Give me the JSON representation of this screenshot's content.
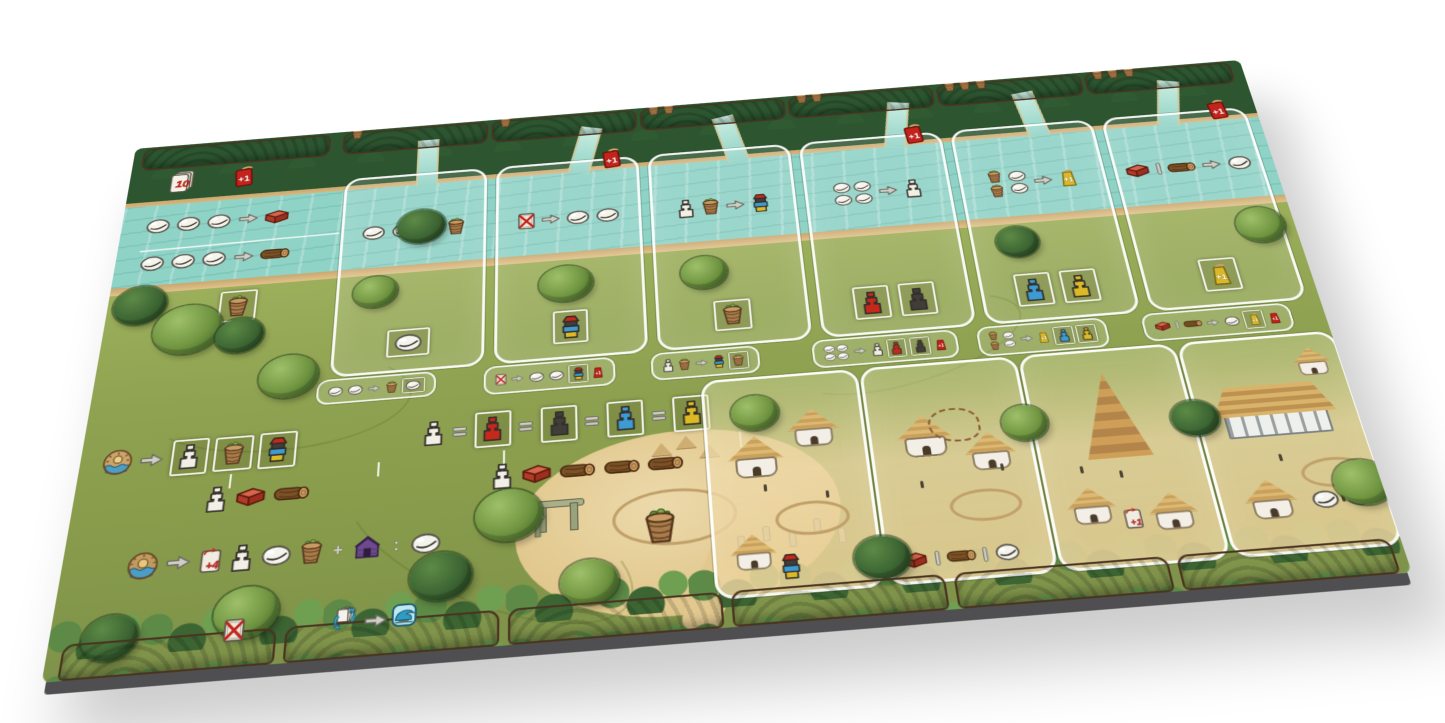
{
  "colors": {
    "page_background": "#ffffff",
    "river": "#8fd2c6",
    "field_green": "#93a653",
    "forest_green": "#2c5530",
    "wood_edge": "#7d5b3a",
    "sand": "#e5cf9f",
    "board_side": "#4f4f52",
    "frame_white": "#f2f2ea",
    "brick_red": "#b23a28",
    "log_brown": "#7c5126",
    "basket_brown": "#aa7c4c",
    "shell_white": "#f5f4ec",
    "statue_white": "#f1efe6",
    "statue_red": "#c6281c",
    "statue_black": "#413d39",
    "statue_blue": "#3e9ad2",
    "statue_yellow": "#ddba25",
    "tag_red": "#c3231b",
    "tag_yellow": "#d9b92a",
    "hut_purple": "#6d4a8c",
    "flood_blue": "#2e9cc3"
  },
  "top_edge": {
    "tabs": [
      {
        "baskets": []
      },
      {
        "baskets": [
          "basket"
        ]
      },
      {
        "baskets": [
          "basket"
        ]
      },
      {
        "baskets": [
          "basket",
          "basket"
        ]
      },
      {
        "baskets": [
          "basket",
          "basket"
        ]
      },
      {
        "baskets": [
          "basket",
          "basket",
          "basket"
        ]
      },
      {
        "baskets": [
          "basket",
          "basket",
          "basket"
        ]
      }
    ]
  },
  "deck_area": {
    "icons": [
      "deck:10",
      "cardred:+1"
    ]
  },
  "river_trades": {
    "shells_to_brick": [
      "disc",
      "disc",
      "disc",
      "arrow",
      "brick"
    ],
    "shells_to_log": [
      "disc",
      "disc",
      "disc",
      "arrow",
      "log"
    ],
    "basket_storage": [
      "frame:basket"
    ]
  },
  "columns": [
    {
      "id": "column-1",
      "header": [],
      "action": [
        "disc",
        "disc",
        "arrow",
        "basket"
      ],
      "slots": [
        "frame:disc"
      ],
      "strip": [
        "disc",
        "disc",
        "arrow",
        "basket",
        "frame:disc"
      ]
    },
    {
      "id": "column-2",
      "header": [
        "cardred:+1"
      ],
      "action": [
        "cardx",
        "arrow",
        "disc",
        "disc"
      ],
      "slots": [
        "frame:stack"
      ],
      "strip": [
        "cardx",
        "arrow",
        "disc",
        "disc",
        "frame:stack",
        "tagred:+1"
      ]
    },
    {
      "id": "column-3",
      "header": [],
      "action": [
        "statue-white",
        "basket",
        "arrow",
        "stack"
      ],
      "slots": [
        "frame:basket"
      ],
      "strip": [
        "statue-white",
        "basket",
        "arrow",
        "stack",
        "frame:basket"
      ]
    },
    {
      "id": "column-4",
      "header": [
        "cardred:+1"
      ],
      "action": [
        "disc4",
        "arrow",
        "statue-white"
      ],
      "slots": [
        "frame:statue-red",
        "frame:statue-black"
      ],
      "strip": [
        "disc4",
        "arrow",
        "statue-white",
        "frame:statue-red",
        "frame:statue-black",
        "tagred:+1"
      ]
    },
    {
      "id": "column-5",
      "header": [],
      "action": [
        "basket2v",
        "disc2v",
        "arrow",
        "tagyellow:+1"
      ],
      "slots": [
        "frame:statue-blue",
        "frame:statue-yellow"
      ],
      "strip": [
        "basket2v",
        "disc2v",
        "arrow",
        "tagyellow:+1",
        "frame:statue-blue",
        "frame:statue-yellow"
      ]
    },
    {
      "id": "column-6",
      "header": [
        "cardred:+1"
      ],
      "action": [
        "brick",
        "or",
        "log",
        "arrow",
        "disc"
      ],
      "slots": [
        "frame:tagyellow:+1"
      ],
      "strip": [
        "brick",
        "or",
        "log",
        "arrow",
        "disc",
        "frame:tagyellow:+1",
        "tagred:+1"
      ]
    }
  ],
  "setup_row": {
    "icons": [
      "sun",
      "arrow",
      "frame:statue-white",
      "frame:basket",
      "frame:stack"
    ],
    "sub": [
      "statue-white",
      "brick",
      "log"
    ]
  },
  "equivalence_row": {
    "icons": [
      "statue-white",
      "eq",
      "frame:statue-red",
      "eq",
      "frame:statue-black",
      "eq",
      "frame:statue-blue",
      "eq",
      "frame:statue-yellow"
    ],
    "sub": [
      "statue-white",
      "brick",
      "log",
      "log",
      "log"
    ]
  },
  "income_row": {
    "icons": [
      "sunwave",
      "arrow",
      "card:+4",
      "statue-white",
      "disc",
      "basket",
      "plus",
      "hutpurple",
      "colon",
      "disc"
    ]
  },
  "bottom_edge": {
    "tabs": [
      {
        "icons": [
          "cardx"
        ]
      },
      {
        "icons": [
          "shuffle",
          "arrow",
          "wave"
        ]
      },
      {
        "icons": []
      },
      {
        "icons": []
      },
      {
        "icons": []
      },
      {
        "icons": []
      }
    ]
  },
  "center_decor": {
    "big_basket": [
      "basket"
    ]
  },
  "villages": [
    {
      "id": "village-1",
      "icons": [
        "stack"
      ]
    },
    {
      "id": "village-2",
      "icons": [
        "brick",
        "or",
        "log",
        "or",
        "disc"
      ]
    },
    {
      "id": "village-3",
      "icons": [
        "carddraw:+1"
      ]
    },
    {
      "id": "village-4",
      "icons": [
        "disc",
        "disc"
      ]
    }
  ]
}
